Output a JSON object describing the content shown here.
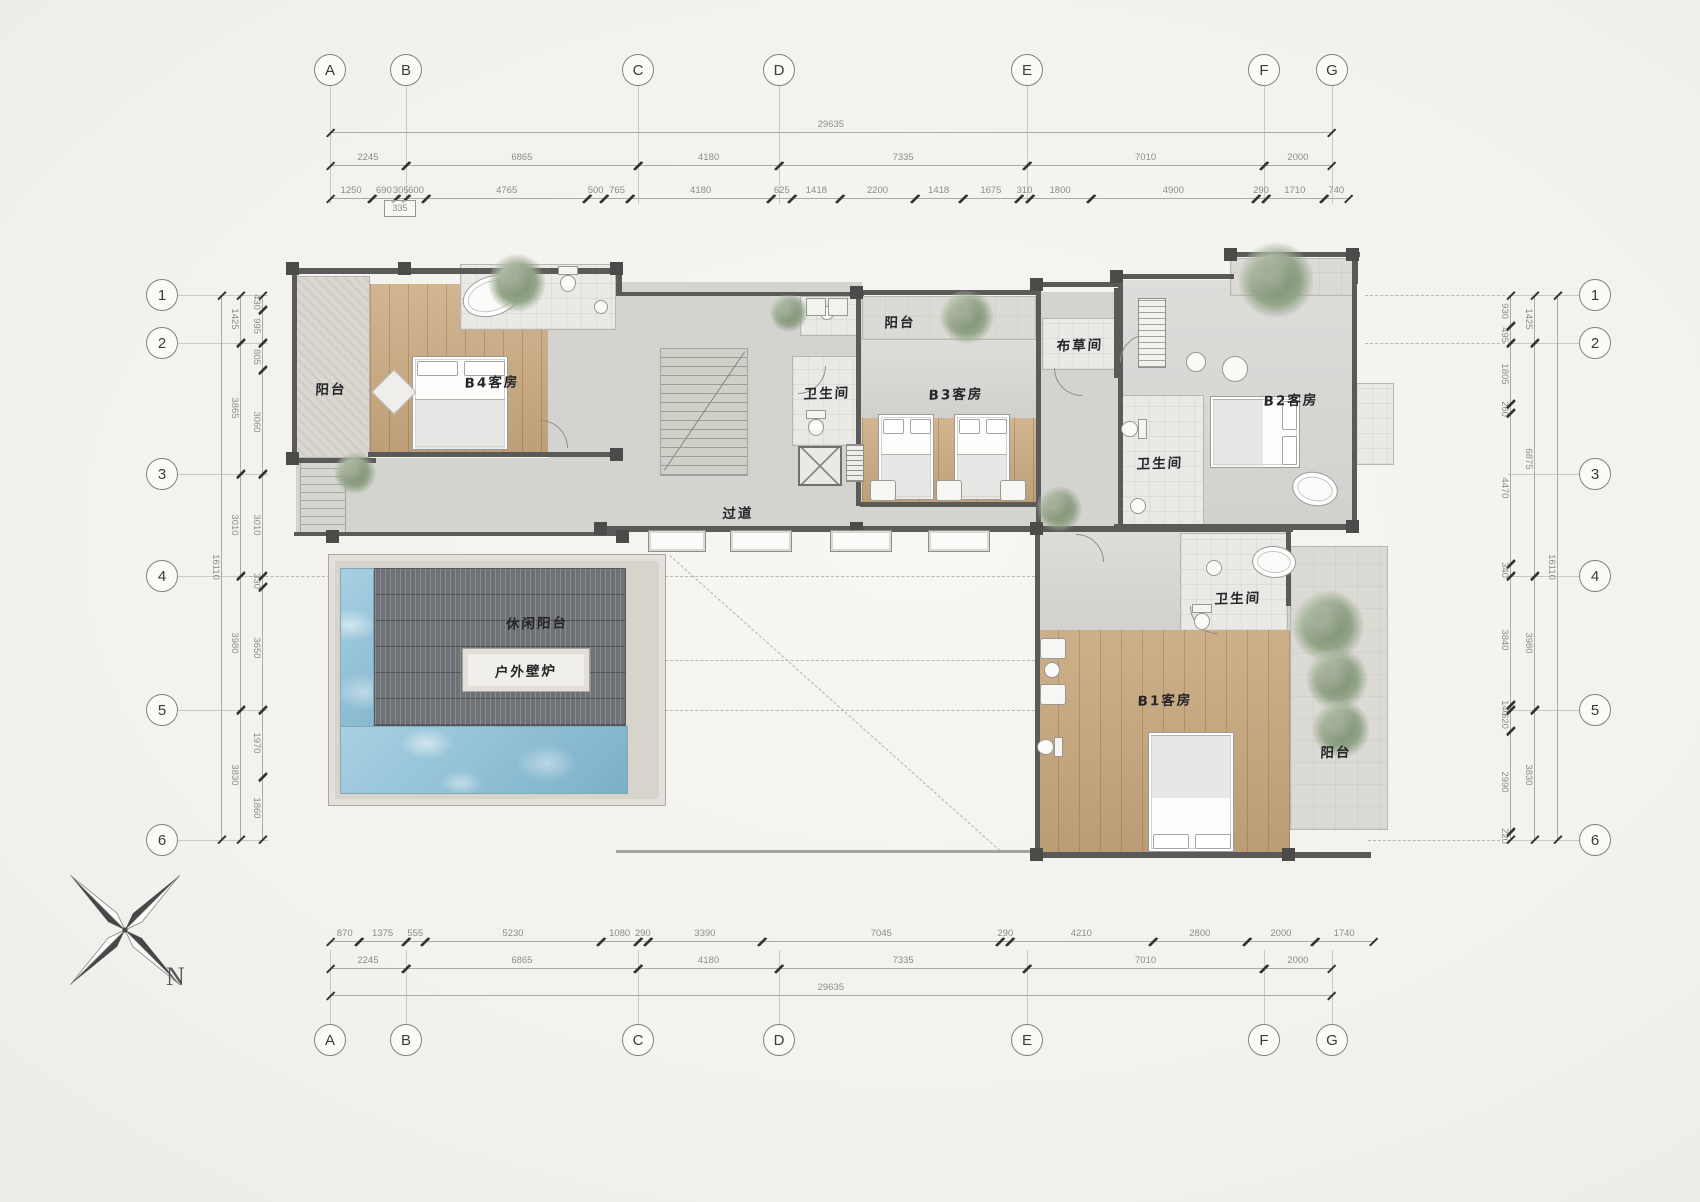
{
  "grid": {
    "columns": [
      "A",
      "B",
      "C",
      "D",
      "E",
      "F",
      "G"
    ],
    "rows": [
      "1",
      "2",
      "3",
      "4",
      "5",
      "6"
    ]
  },
  "dimensions": {
    "top_total": "29635",
    "top_major": [
      "2245",
      "6865",
      "4180",
      "7335",
      "7010",
      "2000"
    ],
    "top_fine": [
      "1250",
      "690",
      "305",
      "600",
      "4765",
      "500",
      "765",
      "4180",
      "625",
      "1418",
      "2200",
      "1418",
      "1675",
      "310",
      "1800",
      "4900",
      "290",
      "1710",
      "740"
    ],
    "top_note": "335",
    "bottom_fine": [
      "870",
      "1375",
      "555",
      "5230",
      "1080",
      "290",
      "3390",
      "7045",
      "290",
      "4210",
      "2800",
      "2000",
      "1740"
    ],
    "bottom_major": [
      "2245",
      "6865",
      "4180",
      "7335",
      "7010",
      "2000"
    ],
    "bottom_total": "29635",
    "left_inner": [
      "430",
      "995",
      "805",
      "3060",
      "3010",
      "330",
      "3650",
      "1970",
      "1860"
    ],
    "left_mid": [
      "1425",
      "3865",
      "3010",
      "3980",
      "3830"
    ],
    "left_total": "16110",
    "right_inner": [
      "930",
      "495",
      "1805",
      "260",
      "4470",
      "340",
      "3840",
      "140",
      "620",
      "2990",
      "220"
    ],
    "right_mid": [
      "1425",
      "6875",
      "3980",
      "3830"
    ],
    "right_total": "16110"
  },
  "rooms": [
    {
      "id": "balcony-top-left",
      "label": "阳台"
    },
    {
      "id": "b4-guest-room",
      "label": "B4客房"
    },
    {
      "id": "bathroom-core",
      "label": "卫生间"
    },
    {
      "id": "balcony-top-middle",
      "label": "阳台"
    },
    {
      "id": "b3-guest-room",
      "label": "B3客房"
    },
    {
      "id": "linen-room",
      "label": "布草间"
    },
    {
      "id": "b2-guest-room",
      "label": "B2客房"
    },
    {
      "id": "bathroom-b2",
      "label": "卫生间"
    },
    {
      "id": "corridor",
      "label": "过道"
    },
    {
      "id": "leisure-balcony",
      "label": "休闲阳台"
    },
    {
      "id": "outdoor-fireplace",
      "label": "户外壁炉"
    },
    {
      "id": "bathroom-b1",
      "label": "卫生间"
    },
    {
      "id": "b1-guest-room",
      "label": "B1客房"
    },
    {
      "id": "balcony-bottom-right",
      "label": "阳台"
    }
  ],
  "compass": {
    "north_label": "N"
  },
  "colors": {
    "wall": "#5a5a58",
    "wood": "#cbaa80",
    "pool": "#8fc3da",
    "deck": "#6e7175",
    "plant": "#93a488",
    "dim_text": "#8c8c8a",
    "paper": "#f2f1ed"
  }
}
